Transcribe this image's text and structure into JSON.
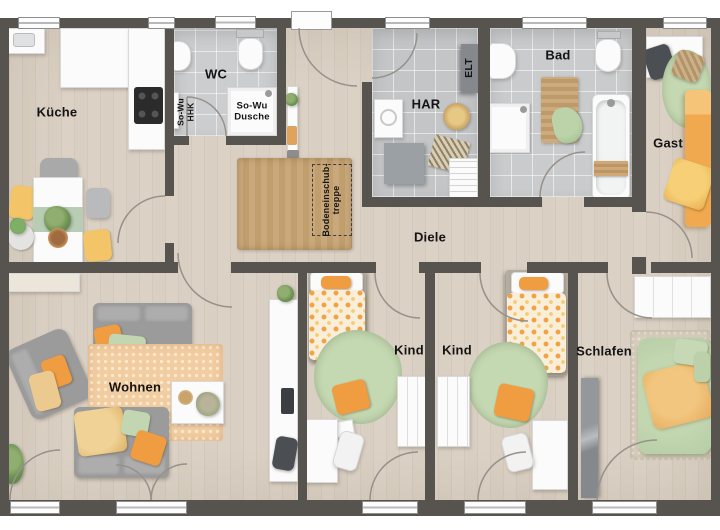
{
  "plan_title": "Grundriss Erdgeschoss",
  "rooms": {
    "kueche": {
      "label": "Küche"
    },
    "wc": {
      "label": "WC"
    },
    "hhk": {
      "line1": "So-Wu",
      "line2": "HHK"
    },
    "dusche": {
      "line1": "So-Wu",
      "line2": "Dusche"
    },
    "har": {
      "label": "HAR"
    },
    "elt": {
      "label": "ELT"
    },
    "bad": {
      "label": "Bad"
    },
    "gast": {
      "label": "Gast"
    },
    "diele": {
      "label": "Diele"
    },
    "attic": {
      "line1": "Bodeneinschub-",
      "line2": "treppe"
    },
    "wohnen": {
      "label": "Wohnen"
    },
    "kind1": {
      "label": "Kind"
    },
    "kind2": {
      "label": "Kind"
    },
    "schlafen": {
      "label": "Schlafen"
    }
  },
  "colors": {
    "wall": "#57534f",
    "wood_floor": "#d9cfc2",
    "tile_wc": "#cbcdcf",
    "tile_har": "#c3c5c7",
    "tile_bad": "#c9cbcc",
    "accent_orange": "#f09c40",
    "accent_green": "#b6cda6",
    "accent_yellow": "#f2c35e",
    "sofa_gray": "#9b9b9b",
    "rug_orange": "#f2cda2",
    "rug_jute": "#c9a97c",
    "door_arc": "#97918a"
  }
}
